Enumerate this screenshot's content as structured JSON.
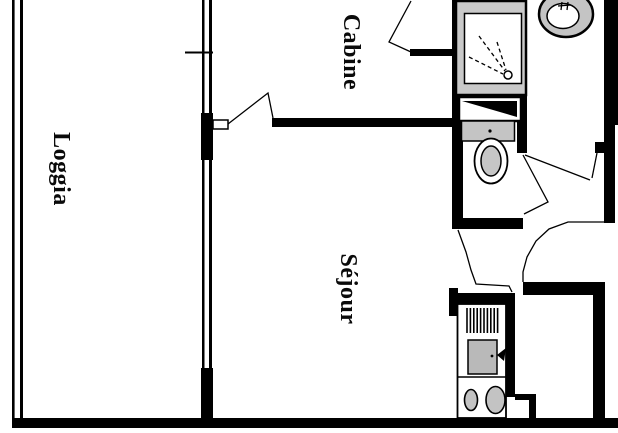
{
  "plan": {
    "rooms": [
      {
        "id": "loggia",
        "label": "Loggia"
      },
      {
        "id": "cabine",
        "label": "Cabine"
      },
      {
        "id": "sejour",
        "label": "Séjour"
      }
    ],
    "fixtures": [
      {
        "id": "shower",
        "label": "shower"
      },
      {
        "id": "washbasin",
        "label": "washbasin"
      },
      {
        "id": "vanity",
        "label": "vanity"
      },
      {
        "id": "toilet",
        "label": "toilet"
      },
      {
        "id": "kitchenette",
        "label": "kitchenette"
      }
    ],
    "colors": {
      "wall": "#000000",
      "background": "#ffffff",
      "shower_frame": "#c9c9c9",
      "fixture_gray": "#c4c4c4",
      "toilet_gray": "#c6c6c6",
      "oven_gray": "#b9b9b9",
      "burner_gray": "#c3c3c3"
    }
  }
}
